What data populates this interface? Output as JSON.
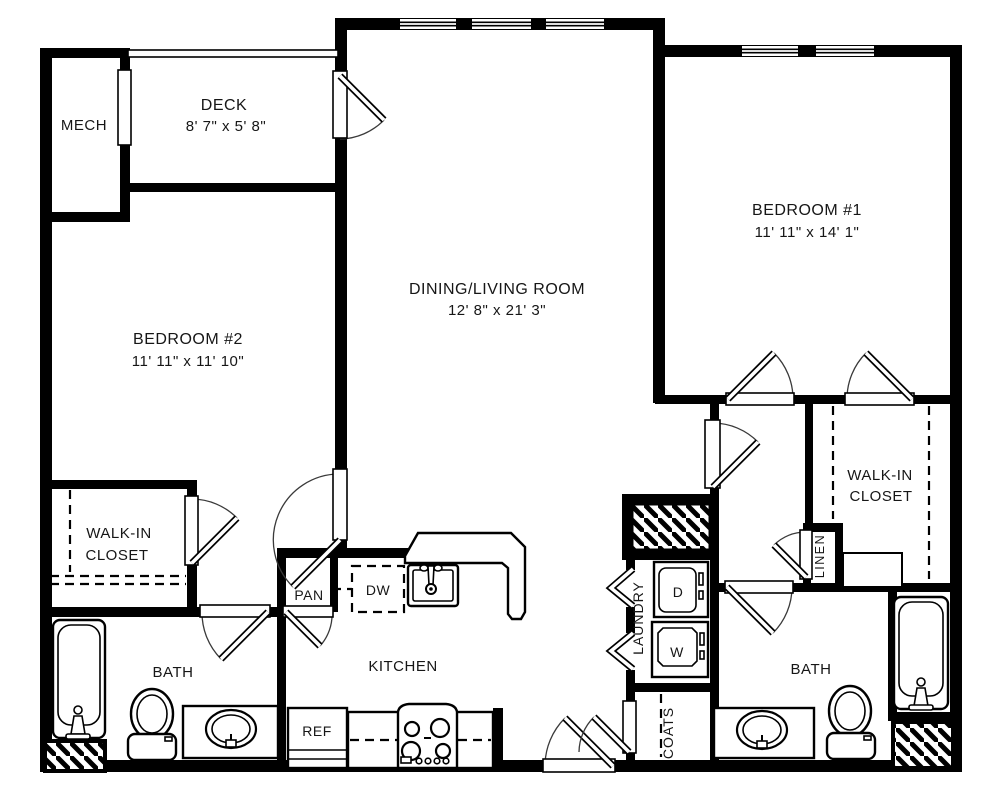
{
  "rooms": {
    "mech": {
      "label": "MECH"
    },
    "deck": {
      "label": "DECK",
      "dims": "8' 7\" x 5' 8\""
    },
    "living": {
      "label": "DINING/LIVING ROOM",
      "dims": "12' 8\" x 21' 3\""
    },
    "bedroom1": {
      "label": "BEDROOM #1",
      "dims": "11' 11\" x 14' 1\""
    },
    "bedroom2": {
      "label": "BEDROOM #2",
      "dims": "11' 11\" x 11' 10\""
    },
    "walk_in_closet_left": {
      "line1": "WALK-IN",
      "line2": "CLOSET"
    },
    "walk_in_closet_right": {
      "line1": "WALK-IN",
      "line2": "CLOSET"
    },
    "bath_left": {
      "label": "BATH"
    },
    "bath_right": {
      "label": "BATH"
    },
    "kitchen": {
      "label": "KITCHEN"
    },
    "pantry": {
      "label": "PAN"
    },
    "laundry": {
      "label": "LAUNDRY"
    },
    "coats": {
      "label": "COATS"
    },
    "linen": {
      "label": "LINEN"
    }
  },
  "appliances": {
    "dishwasher_label": "DW",
    "refrigerator_label": "REF",
    "dryer_label": "D",
    "washer_label": "W"
  },
  "colors": {
    "wall": "#000000",
    "background": "#ffffff",
    "text": "#161616"
  }
}
